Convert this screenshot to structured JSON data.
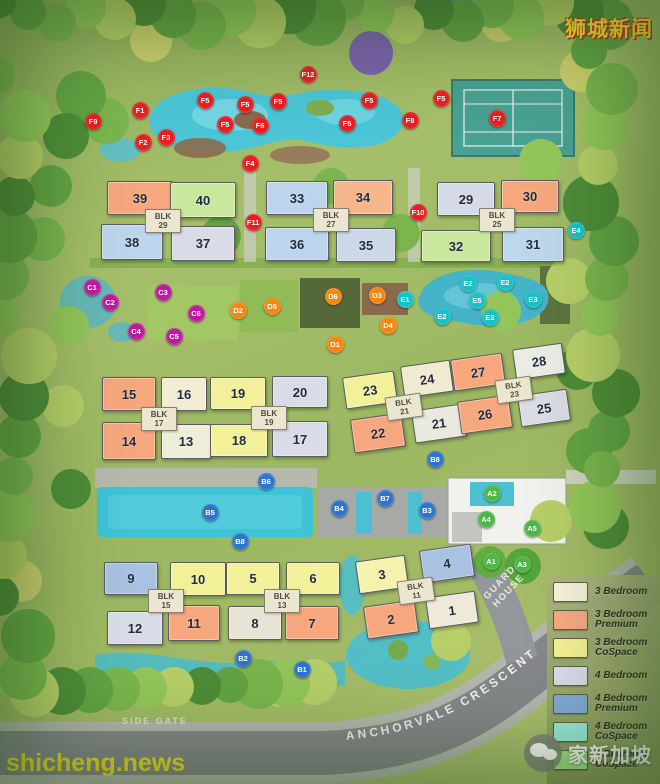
{
  "watermarks": {
    "top_right": "狮城新闻",
    "bottom_left": "shicheng.news",
    "bottom_right": "家新加坡"
  },
  "labels": {
    "road": "ANCHORVALE CRESCENT",
    "side_gate": "SIDE GATE",
    "guard_house_line1": "GUARD",
    "guard_house_line2": "HOUSE"
  },
  "legend": [
    {
      "lines": [
        "3 Bedroom"
      ],
      "color": "#f6f2da"
    },
    {
      "lines": [
        "3 Bedroom",
        "Premium"
      ],
      "color": "#f6a982"
    },
    {
      "lines": [
        "3 Bedroom",
        "CoSpace"
      ],
      "color": "#f4f096"
    },
    {
      "lines": [
        "4 Bedroom"
      ],
      "color": "#d8dde9"
    },
    {
      "lines": [
        "4 Bedroom",
        "Premium"
      ],
      "color": "#84abda"
    },
    {
      "lines": [
        "4 Bedroom",
        "CoSpace"
      ],
      "color": "#9cf0e2"
    },
    {
      "lines": [
        "5 Bedroom",
        "CoSpace"
      ],
      "color": "#a7e98b"
    }
  ],
  "blocks": [
    {
      "label": "BLK",
      "number": "29",
      "x": 162,
      "y": 220,
      "rot": 0
    },
    {
      "label": "BLK",
      "number": "27",
      "x": 330,
      "y": 219,
      "rot": 0
    },
    {
      "label": "BLK",
      "number": "25",
      "x": 496,
      "y": 219,
      "rot": 0
    },
    {
      "label": "BLK",
      "number": "17",
      "x": 158,
      "y": 418,
      "rot": 0
    },
    {
      "label": "BLK",
      "number": "19",
      "x": 268,
      "y": 417,
      "rot": 0
    },
    {
      "label": "BLK",
      "number": "21",
      "x": 403,
      "y": 406,
      "rot": -8
    },
    {
      "label": "BLK",
      "number": "23",
      "x": 513,
      "y": 389,
      "rot": -8
    },
    {
      "label": "BLK",
      "number": "15",
      "x": 165,
      "y": 600,
      "rot": 0
    },
    {
      "label": "BLK",
      "number": "13",
      "x": 281,
      "y": 600,
      "rot": 0
    },
    {
      "label": "BLK",
      "number": "11",
      "x": 415,
      "y": 590,
      "rot": -8
    }
  ],
  "buildings": [
    {
      "no": "39",
      "type": "3 Bedroom Premium",
      "fill": "#f6a77e",
      "x": 107,
      "y": 181,
      "w": 64,
      "h": 32,
      "rot": 0
    },
    {
      "no": "40",
      "type": "5 Bedroom CoSpace",
      "fill": "#c9e89e",
      "x": 170,
      "y": 182,
      "w": 64,
      "h": 34,
      "rot": 0
    },
    {
      "no": "38",
      "type": "4 Bedroom",
      "fill": "#bdd5ec",
      "x": 101,
      "y": 224,
      "w": 60,
      "h": 34,
      "rot": 0
    },
    {
      "no": "37",
      "type": "4 Bedroom",
      "fill": "#d9dce6",
      "x": 171,
      "y": 226,
      "w": 62,
      "h": 33,
      "rot": 0
    },
    {
      "no": "33",
      "type": "4 Bedroom",
      "fill": "#bdd5ec",
      "x": 266,
      "y": 181,
      "w": 60,
      "h": 32,
      "rot": 0
    },
    {
      "no": "34",
      "type": "3 Bedroom Premium",
      "fill": "#f6b68c",
      "x": 333,
      "y": 180,
      "w": 58,
      "h": 33,
      "rot": 0
    },
    {
      "no": "36",
      "type": "4 Bedroom",
      "fill": "#bdd5ec",
      "x": 265,
      "y": 227,
      "w": 62,
      "h": 32,
      "rot": 0
    },
    {
      "no": "35",
      "type": "4 Bedroom",
      "fill": "#ccd7e8",
      "x": 336,
      "y": 228,
      "w": 58,
      "h": 32,
      "rot": 0
    },
    {
      "no": "29",
      "type": "4 Bedroom",
      "fill": "#d5dae6",
      "x": 437,
      "y": 182,
      "w": 56,
      "h": 32,
      "rot": 0
    },
    {
      "no": "30",
      "type": "3 Bedroom Premium",
      "fill": "#f6a77e",
      "x": 501,
      "y": 180,
      "w": 56,
      "h": 31,
      "rot": 0
    },
    {
      "no": "32",
      "type": "5 Bedroom CoSpace",
      "fill": "#c9e89e",
      "x": 421,
      "y": 230,
      "w": 68,
      "h": 30,
      "rot": 0
    },
    {
      "no": "31",
      "type": "4 Bedroom",
      "fill": "#bdd7ec",
      "x": 502,
      "y": 227,
      "w": 60,
      "h": 33,
      "rot": 0
    },
    {
      "no": "15",
      "type": "3 Bedroom Premium",
      "fill": "#f6a77e",
      "x": 102,
      "y": 377,
      "w": 52,
      "h": 32,
      "rot": 0
    },
    {
      "no": "16",
      "type": "3 Bedroom",
      "fill": "#f1ecd2",
      "x": 161,
      "y": 377,
      "w": 44,
      "h": 32,
      "rot": 0
    },
    {
      "no": "14",
      "type": "3 Bedroom Premium",
      "fill": "#f6a77e",
      "x": 102,
      "y": 422,
      "w": 52,
      "h": 36,
      "rot": 0
    },
    {
      "no": "13",
      "type": "3 Bedroom",
      "fill": "#eeedda",
      "x": 161,
      "y": 424,
      "w": 48,
      "h": 33,
      "rot": 0
    },
    {
      "no": "19",
      "type": "3 Bedroom CoSpace",
      "fill": "#f3f09a",
      "x": 210,
      "y": 377,
      "w": 54,
      "h": 31,
      "rot": 0
    },
    {
      "no": "20",
      "type": "4 Bedroom",
      "fill": "#d9dce6",
      "x": 272,
      "y": 376,
      "w": 54,
      "h": 30,
      "rot": 0
    },
    {
      "no": "18",
      "type": "3 Bedroom CoSpace",
      "fill": "#f3f09a",
      "x": 210,
      "y": 424,
      "w": 56,
      "h": 31,
      "rot": 0
    },
    {
      "no": "17",
      "type": "4 Bedroom",
      "fill": "#d9dce6",
      "x": 272,
      "y": 421,
      "w": 54,
      "h": 34,
      "rot": 0
    },
    {
      "no": "23",
      "type": "3 Bedroom CoSpace",
      "fill": "#f3f09a",
      "x": 344,
      "y": 374,
      "w": 50,
      "h": 30,
      "rot": -8
    },
    {
      "no": "24",
      "type": "3 Bedroom",
      "fill": "#f0ead2",
      "x": 402,
      "y": 363,
      "w": 48,
      "h": 30,
      "rot": -8
    },
    {
      "no": "22",
      "type": "3 Bedroom Premium",
      "fill": "#f6a77e",
      "x": 352,
      "y": 416,
      "w": 50,
      "h": 32,
      "rot": -8
    },
    {
      "no": "21",
      "type": "3 Bedroom",
      "fill": "#e9e9df",
      "x": 413,
      "y": 407,
      "w": 50,
      "h": 31,
      "rot": -8
    },
    {
      "no": "27",
      "type": "3 Bedroom Premium",
      "fill": "#f6a77e",
      "x": 452,
      "y": 356,
      "w": 50,
      "h": 30,
      "rot": -8
    },
    {
      "no": "28",
      "type": "3 Bedroom",
      "fill": "#ebece4",
      "x": 514,
      "y": 346,
      "w": 48,
      "h": 29,
      "rot": -8
    },
    {
      "no": "26",
      "type": "3 Bedroom Premium",
      "fill": "#f6a77e",
      "x": 459,
      "y": 398,
      "w": 50,
      "h": 31,
      "rot": -8
    },
    {
      "no": "25",
      "type": "4 Bedroom",
      "fill": "#dadde3",
      "x": 519,
      "y": 392,
      "w": 48,
      "h": 30,
      "rot": -8
    },
    {
      "no": "9",
      "type": "4 Bedroom Premium",
      "fill": "#a9c2e2",
      "x": 104,
      "y": 562,
      "w": 52,
      "h": 31,
      "rot": 0
    },
    {
      "no": "10",
      "type": "3 Bedroom CoSpace",
      "fill": "#f3f09a",
      "x": 170,
      "y": 562,
      "w": 54,
      "h": 32,
      "rot": 0
    },
    {
      "no": "12",
      "type": "4 Bedroom",
      "fill": "#d9dce6",
      "x": 107,
      "y": 611,
      "w": 54,
      "h": 32,
      "rot": 0
    },
    {
      "no": "11",
      "type": "3 Bedroom Premium",
      "fill": "#f6a77e",
      "x": 168,
      "y": 605,
      "w": 50,
      "h": 34,
      "rot": 0
    },
    {
      "no": "5",
      "type": "3 Bedroom CoSpace",
      "fill": "#f3f09a",
      "x": 226,
      "y": 562,
      "w": 52,
      "h": 31,
      "rot": 0
    },
    {
      "no": "6",
      "type": "3 Bedroom CoSpace",
      "fill": "#f3f09a",
      "x": 286,
      "y": 562,
      "w": 52,
      "h": 31,
      "rot": 0
    },
    {
      "no": "8",
      "type": "3 Bedroom",
      "fill": "#e8e3d2",
      "x": 228,
      "y": 606,
      "w": 52,
      "h": 32,
      "rot": 0
    },
    {
      "no": "7",
      "type": "3 Bedroom Premium",
      "fill": "#f6a77e",
      "x": 285,
      "y": 606,
      "w": 52,
      "h": 32,
      "rot": 0
    },
    {
      "no": "3",
      "type": "3 Bedroom CoSpace",
      "fill": "#f5f2ae",
      "x": 357,
      "y": 558,
      "w": 48,
      "h": 31,
      "rot": -8
    },
    {
      "no": "4",
      "type": "4 Bedroom Premium",
      "fill": "#a9c2e2",
      "x": 421,
      "y": 547,
      "w": 50,
      "h": 31,
      "rot": -8
    },
    {
      "no": "2",
      "type": "3 Bedroom Premium",
      "fill": "#f6a77e",
      "x": 365,
      "y": 603,
      "w": 50,
      "h": 31,
      "rot": -8
    },
    {
      "no": "1",
      "type": "3 Bedroom",
      "fill": "#eee9d8",
      "x": 427,
      "y": 594,
      "w": 48,
      "h": 30,
      "rot": -8
    }
  ],
  "marker_colors": {
    "A": "#4eb648",
    "B": "#2e74cc",
    "C": "#c0189f",
    "D": "#f6860e",
    "E": "#16c2c8",
    "F": "#e81e20"
  },
  "markers": [
    {
      "id": "F9",
      "g": "F",
      "x": 93,
      "y": 121
    },
    {
      "id": "F1",
      "g": "F",
      "x": 140,
      "y": 110
    },
    {
      "id": "F2",
      "g": "F",
      "x": 143,
      "y": 142
    },
    {
      "id": "F3",
      "g": "F",
      "x": 166,
      "y": 137
    },
    {
      "id": "F5",
      "g": "F",
      "x": 205,
      "y": 100
    },
    {
      "id": "F5",
      "g": "F",
      "x": 245,
      "y": 104
    },
    {
      "id": "F5",
      "g": "F",
      "x": 278,
      "y": 101
    },
    {
      "id": "F5",
      "g": "F",
      "x": 225,
      "y": 124
    },
    {
      "id": "F6",
      "g": "F",
      "x": 260,
      "y": 125
    },
    {
      "id": "F5",
      "g": "F",
      "x": 347,
      "y": 123
    },
    {
      "id": "F5",
      "g": "F",
      "x": 369,
      "y": 100
    },
    {
      "id": "F5",
      "g": "F",
      "x": 441,
      "y": 98
    },
    {
      "id": "F12",
      "g": "F",
      "x": 308,
      "y": 74
    },
    {
      "id": "F4",
      "g": "F",
      "x": 250,
      "y": 163
    },
    {
      "id": "F8",
      "g": "F",
      "x": 410,
      "y": 120
    },
    {
      "id": "F7",
      "g": "F",
      "x": 497,
      "y": 118
    },
    {
      "id": "F10",
      "g": "F",
      "x": 418,
      "y": 212
    },
    {
      "id": "F11",
      "g": "F",
      "x": 253,
      "y": 222
    },
    {
      "id": "E4",
      "g": "E",
      "x": 576,
      "y": 230
    },
    {
      "id": "C1",
      "g": "C",
      "x": 92,
      "y": 287
    },
    {
      "id": "C2",
      "g": "C",
      "x": 110,
      "y": 302
    },
    {
      "id": "C3",
      "g": "C",
      "x": 163,
      "y": 292
    },
    {
      "id": "C4",
      "g": "C",
      "x": 136,
      "y": 331
    },
    {
      "id": "C5",
      "g": "C",
      "x": 174,
      "y": 336
    },
    {
      "id": "C6",
      "g": "C",
      "x": 196,
      "y": 313
    },
    {
      "id": "D2",
      "g": "D",
      "x": 238,
      "y": 310
    },
    {
      "id": "D5",
      "g": "D",
      "x": 272,
      "y": 306
    },
    {
      "id": "D6",
      "g": "D",
      "x": 333,
      "y": 296
    },
    {
      "id": "D3",
      "g": "D",
      "x": 377,
      "y": 295
    },
    {
      "id": "D4",
      "g": "D",
      "x": 388,
      "y": 325
    },
    {
      "id": "D1",
      "g": "D",
      "x": 335,
      "y": 344
    },
    {
      "id": "E1",
      "g": "E",
      "x": 405,
      "y": 299
    },
    {
      "id": "E2",
      "g": "E",
      "x": 468,
      "y": 283
    },
    {
      "id": "E2",
      "g": "E",
      "x": 505,
      "y": 282
    },
    {
      "id": "E5",
      "g": "E",
      "x": 477,
      "y": 300
    },
    {
      "id": "E2",
      "g": "E",
      "x": 442,
      "y": 316
    },
    {
      "id": "E2",
      "g": "E",
      "x": 490,
      "y": 317
    },
    {
      "id": "E3",
      "g": "E",
      "x": 533,
      "y": 299
    },
    {
      "id": "B8",
      "g": "B",
      "x": 435,
      "y": 459
    },
    {
      "id": "B6",
      "g": "B",
      "x": 266,
      "y": 481
    },
    {
      "id": "B5",
      "g": "B",
      "x": 210,
      "y": 512
    },
    {
      "id": "B4",
      "g": "B",
      "x": 339,
      "y": 508
    },
    {
      "id": "B7",
      "g": "B",
      "x": 385,
      "y": 498
    },
    {
      "id": "B3",
      "g": "B",
      "x": 427,
      "y": 510
    },
    {
      "id": "B8",
      "g": "B",
      "x": 240,
      "y": 541
    },
    {
      "id": "B2",
      "g": "B",
      "x": 243,
      "y": 658
    },
    {
      "id": "B1",
      "g": "B",
      "x": 302,
      "y": 669
    },
    {
      "id": "A2",
      "g": "A",
      "x": 492,
      "y": 493
    },
    {
      "id": "A4",
      "g": "A",
      "x": 486,
      "y": 519
    },
    {
      "id": "A5",
      "g": "A",
      "x": 532,
      "y": 528
    },
    {
      "id": "A1",
      "g": "A",
      "x": 491,
      "y": 561
    },
    {
      "id": "A3",
      "g": "A",
      "x": 522,
      "y": 564
    }
  ]
}
